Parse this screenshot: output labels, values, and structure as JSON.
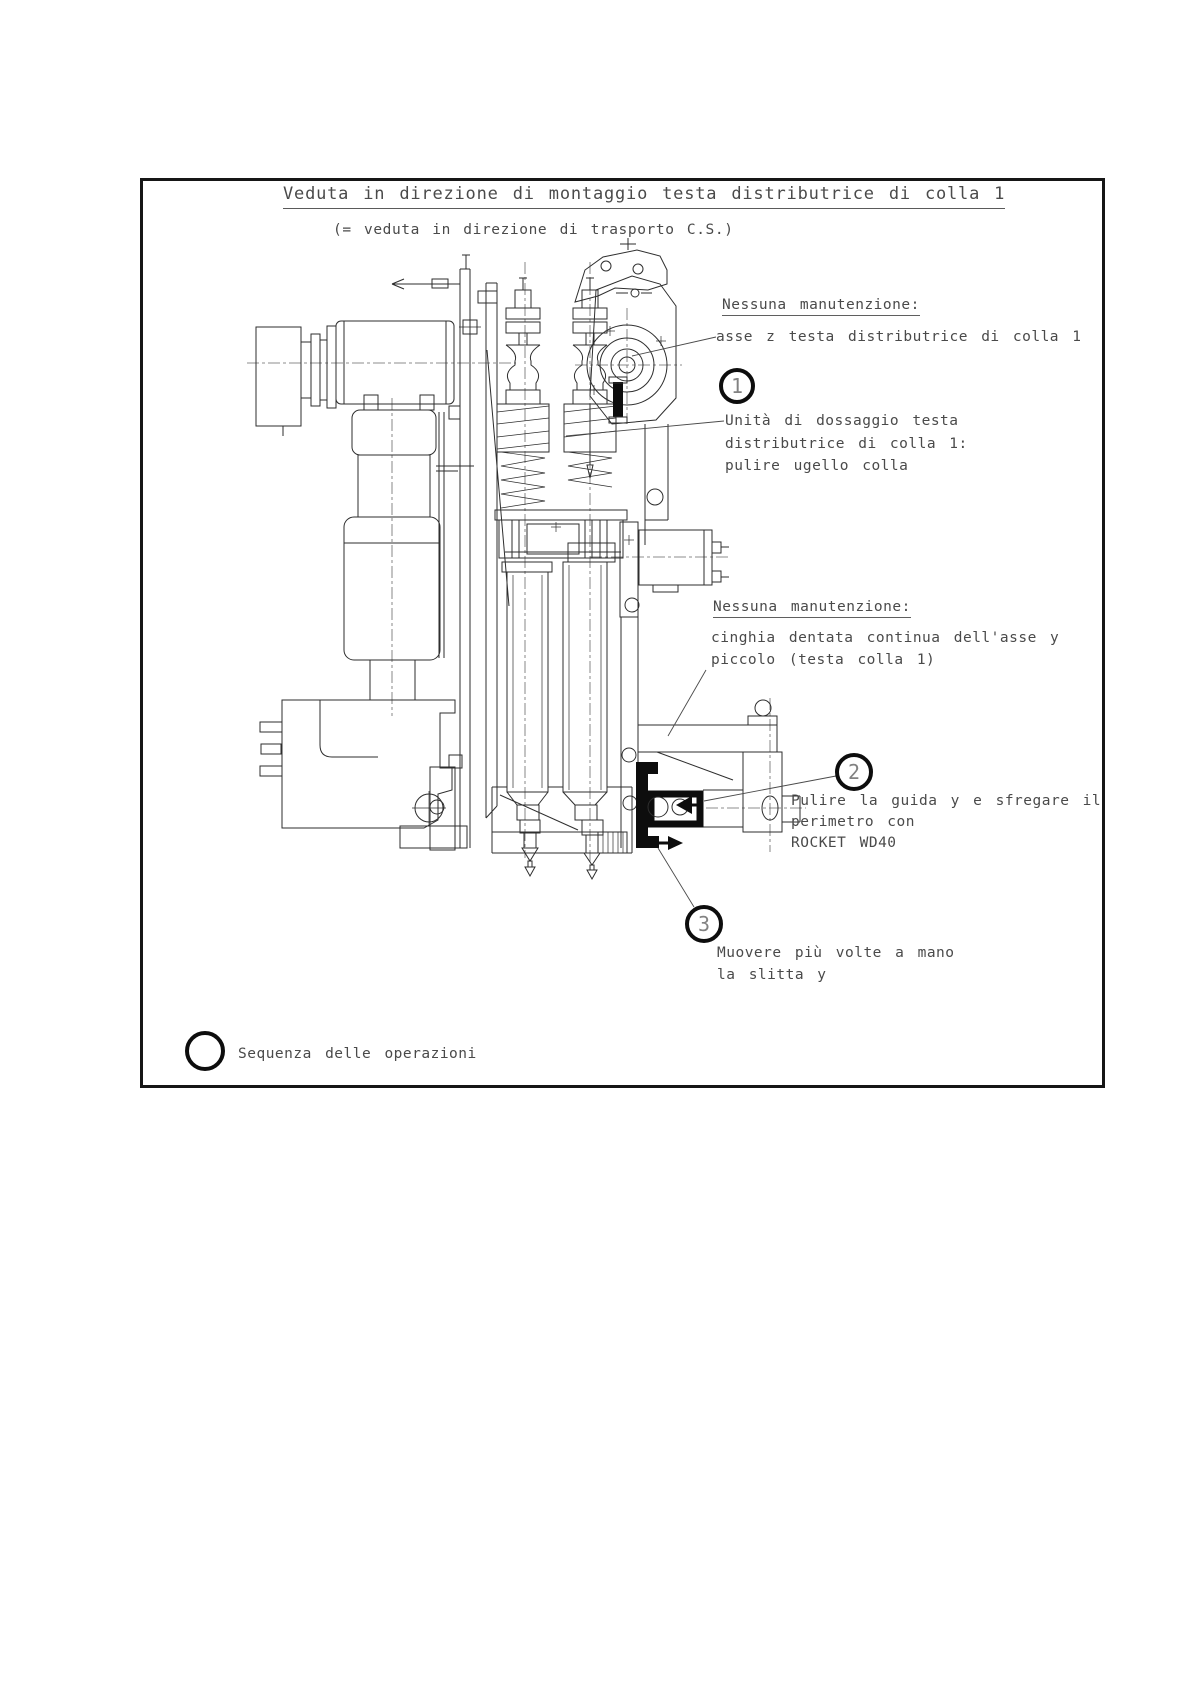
{
  "page": {
    "title": "Veduta in direzione di montaggio testa distributrice di colla 1",
    "subtitle": "(= veduta in direzione di trasporto C.S.)"
  },
  "callouts": {
    "no_maintenance_1": {
      "heading": "Nessuna manutenzione:",
      "line1": "asse z testa distributrice di colla 1"
    },
    "step1": {
      "number": "1",
      "line1": "Unità di dossaggio testa",
      "line2": "distributrice di colla 1:",
      "line3": "pulire ugello colla"
    },
    "no_maintenance_2": {
      "heading": "Nessuna manutenzione:",
      "line1": "cinghia dentata continua dell'asse y",
      "line2": "piccolo (testa colla 1)"
    },
    "step2": {
      "number": "2",
      "line1": "Pulire la guida y e sfregare il",
      "line2": "perimetro con",
      "line3": "ROCKET WD40"
    },
    "step3": {
      "number": "3",
      "line1": "Muovere più volte a mano",
      "line2": "la slitta y"
    },
    "legend": {
      "label": "Sequenza delle operazioni"
    }
  },
  "colors": {
    "line": "#2e2e2e",
    "highlight": "#0d0d0d",
    "text": "#4a4a4a"
  }
}
